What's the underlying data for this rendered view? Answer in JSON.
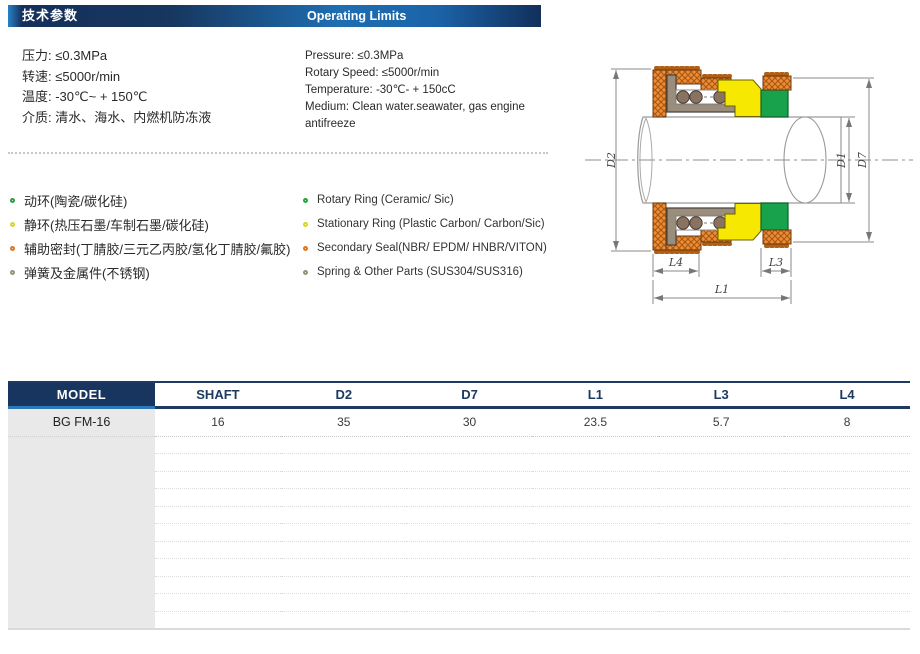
{
  "header": {
    "zh_title": "技术参数",
    "en_title": "Operating Limits"
  },
  "specs": {
    "zh": [
      "压力: ≤0.3MPa",
      "转速: ≤5000r/min",
      "温度: -30℃~ + 150℃",
      "介质: 清水、海水、内燃机防冻液"
    ],
    "en": [
      "Pressure: ≤0.3MPa",
      "Rotary Speed: ≤5000r/min",
      "Temperature: -30℃- + 150cC",
      "Medium: Clean water.seawater, gas engine antifreeze"
    ]
  },
  "materials": {
    "zh": [
      {
        "label": "动环(陶瓷/碳化硅)",
        "color": "#27a23c"
      },
      {
        "label": "静环(热压石墨/车制石墨/碳化硅)",
        "color": "#d6d62b"
      },
      {
        "label": "辅助密封(丁腈胶/三元乙丙胶/氢化丁腈胶/氟胶)",
        "color": "#e0761d"
      },
      {
        "label": "弹簧及金属件(不锈钢)",
        "color": "#98917b"
      }
    ],
    "en": [
      {
        "label": "Rotary Ring (Ceramic/ Sic)",
        "color": "#27a23c"
      },
      {
        "label": "Stationary Ring (Plastic Carbon/ Carbon/Sic)",
        "color": "#d6d62b"
      },
      {
        "label": "Secondary Seal(NBR/ EPDM/ HNBR/VITON)",
        "color": "#e0761d"
      },
      {
        "label": "Spring & Other Parts (SUS304/SUS316)",
        "color": "#98917b"
      }
    ]
  },
  "diagram": {
    "labels": [
      "D2",
      "D1",
      "D7",
      "L4",
      "L3",
      "L1"
    ],
    "colors": {
      "rubber": "#ef8c34",
      "rubber_hatch": "#a65812",
      "seat_yellow": "#f6e800",
      "ring_green": "#18a24b",
      "metal_gray": "#9b8d7c",
      "spring_brown": "#8a7260"
    }
  },
  "table": {
    "headers": [
      "MODEL",
      "SHAFT",
      "D2",
      "D7",
      "L1",
      "L3",
      "L4"
    ],
    "rows": [
      [
        "BG FM-16",
        "16",
        "35",
        "30",
        "23.5",
        "5.7",
        "8"
      ]
    ],
    "empty_row_count": 11
  },
  "colors": {
    "navy": "#17355e",
    "accent_blue": "#1d6fb3",
    "model_underline": "#2e77b8",
    "row_gray": "#e9e9e9"
  }
}
